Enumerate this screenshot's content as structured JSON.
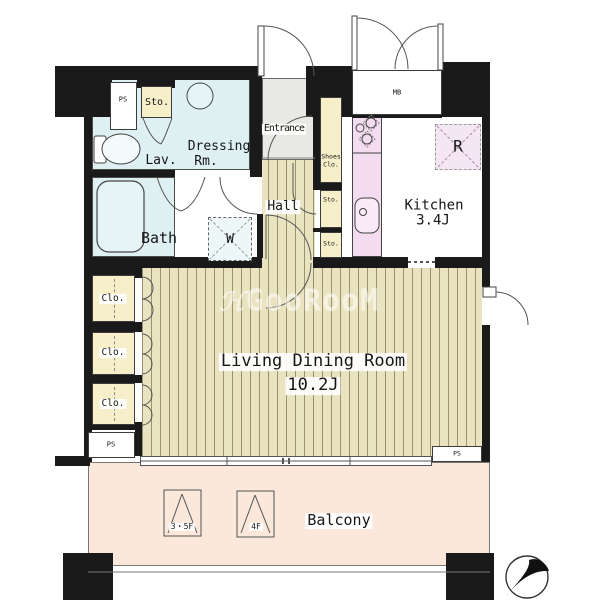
{
  "plan": {
    "watermark": {
      "icon": "ℋ",
      "text": "GooRooM"
    },
    "rooms": {
      "entrance": "Entrance",
      "hall": "Hall",
      "dressing_line1": "Dressing",
      "dressing_line2": "Rm.",
      "lavatory": "Lav.",
      "bath": "Bath",
      "washer": "W",
      "kitchen": "Kitchen",
      "kitchen_size": "3.4J",
      "refrigerator": "R",
      "living": "Living Dining Room",
      "living_size": "10.2J",
      "balcony": "Balcony"
    },
    "storage": {
      "sto_top": "Sto.",
      "shoes_line1": "Shoes",
      "shoes_line2": "Clo.",
      "sto_mid": "Sto.",
      "sto_low": "Sto.",
      "closet1": "Clo.",
      "closet2": "Clo.",
      "closet3": "Clo."
    },
    "service": {
      "ps_top": "PS",
      "ps_bottom_left": "PS",
      "ps_bottom_right": "PS",
      "meter_box": "MB"
    },
    "hatches": {
      "hatch_3_5f": "3・5F",
      "hatch_4f": "4F"
    },
    "colors": {
      "wall": "#1a1a1a",
      "wet_area": "#def0f2",
      "storage_cream": "#f6efc9",
      "wood_floor": "#eae3bf",
      "kitchen_counter": "#f4dcf0",
      "entrance_floor": "#e8e8e5",
      "balcony_peach": "#fbe8da"
    }
  }
}
